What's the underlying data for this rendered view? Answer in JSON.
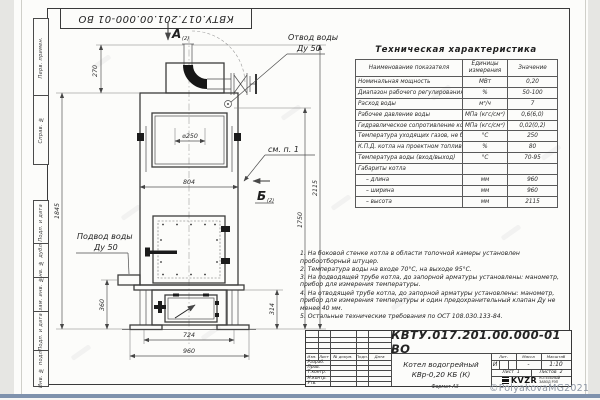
{
  "sheet": {
    "corner_stamp": "КВТУ.017.201.00.000-01 ВО",
    "format_note": "Формат А3",
    "copyright_watermark": "©PolyakovaMG2021"
  },
  "margin_columns": {
    "perv_primen": "Перв. примен.",
    "sprav_no": "Справ. №",
    "podp_data_1": "Подп. и дата",
    "inv_dubl": "Инв. № дубл.",
    "vzam_inv": "Взам. инв. №",
    "podp_data_2": "Подп. и дата",
    "inv_podl": "Инв. № подл."
  },
  "drawing": {
    "view_a": "А",
    "view_a_note": "(2)",
    "view_b": "Б",
    "view_b_note": "(2)",
    "label_outlet_1": "Отвод воды",
    "label_outlet_2": "Ду 50",
    "label_inlet_1": "Подвод воды",
    "label_inlet_2": "Ду 50",
    "label_see_note": "см. п. 1",
    "dims": {
      "chimney_h": "270",
      "flue_d": "⌀250",
      "body_h": "1845",
      "body_w": "804",
      "inlet_h": "360",
      "base_w": "724",
      "overall_w": "960",
      "base_h": "314",
      "outlet_h": "1750",
      "overall_h": "2115"
    }
  },
  "spec_table": {
    "title": "Техническая характеристика",
    "col_name": "Наименование показателя",
    "col_units": "Единицы измерения",
    "col_value": "Значение",
    "rows": [
      {
        "name": "Номинальная мощность",
        "unit": "МВт",
        "value": "0,20"
      },
      {
        "name": "Диапазон рабочего регулирования",
        "unit": "%",
        "value": "50-100"
      },
      {
        "name": "Расход воды",
        "unit": "м³/ч",
        "value": "7"
      },
      {
        "name": "Рабочее давление воды",
        "unit": "МПа (кгс/см²)",
        "value": "0,6(6,0)"
      },
      {
        "name": "Гидравлическое сопротивление котла",
        "unit": "МПа (кгс/см²)",
        "value": "0,02(0,2)"
      },
      {
        "name": "Температура уходящих газов, не более",
        "unit": "°С",
        "value": "250"
      },
      {
        "name": "К.П.Д. котла на проектном топливе",
        "unit": "%",
        "value": "80"
      },
      {
        "name": "Температура воды (вход/выход)",
        "unit": "°С",
        "value": "70-95"
      },
      {
        "name": "Габариты котла",
        "unit": "",
        "value": ""
      },
      {
        "name": "– длина",
        "unit": "мм",
        "value": "960"
      },
      {
        "name": "– ширина",
        "unit": "мм",
        "value": "960"
      },
      {
        "name": "– высота",
        "unit": "мм",
        "value": "2115"
      }
    ]
  },
  "notes": {
    "lines": [
      "1. На боковой стенке котла в области топочной камеры установлен пробоотборный штуцер.",
      "2. Температура воды на входе 70°С, на выходе 95°С.",
      "3. На подводящей трубе котла, до запорной арматуры установлены: манометр, прибор для измерения температуры.",
      "4. На отводящей трубе котла, до запорной арматуры установлены: манометр, прибор для измерения температуры и один предохранительный клапан Ду не менее 40 мм.",
      "5. Остальные технические требования по ОСТ 108.030.133-84."
    ]
  },
  "title_block": {
    "doc_number": "КВТУ.017.201.00.000-01 ВО",
    "product_line1": "Котел водогрейный",
    "product_line2": "КВр-0,20 КБ (К)",
    "hdr_izm": "Изм.",
    "hdr_list": "Лист",
    "hdr_dok": "№ докум.",
    "hdr_podp": "Подп.",
    "hdr_data": "Дата",
    "staff": [
      "Разраб.",
      "Пров.",
      "Т.контр.",
      "Н.контр.",
      "Утв."
    ],
    "lit_label": "Лит.",
    "mass_label": "Масса",
    "scale_label": "Масштаб",
    "lit_value": "И",
    "mass_value": "-",
    "scale_value": "1:10",
    "sheet_label": "Лист",
    "sheet_value": "1",
    "sheets_label": "Листов",
    "sheets_value": "2",
    "logo_name": "KVZR",
    "logo_line1": "КОТЕЛЬНЫЙ",
    "logo_line2": "ЗАВОД РЭП"
  }
}
